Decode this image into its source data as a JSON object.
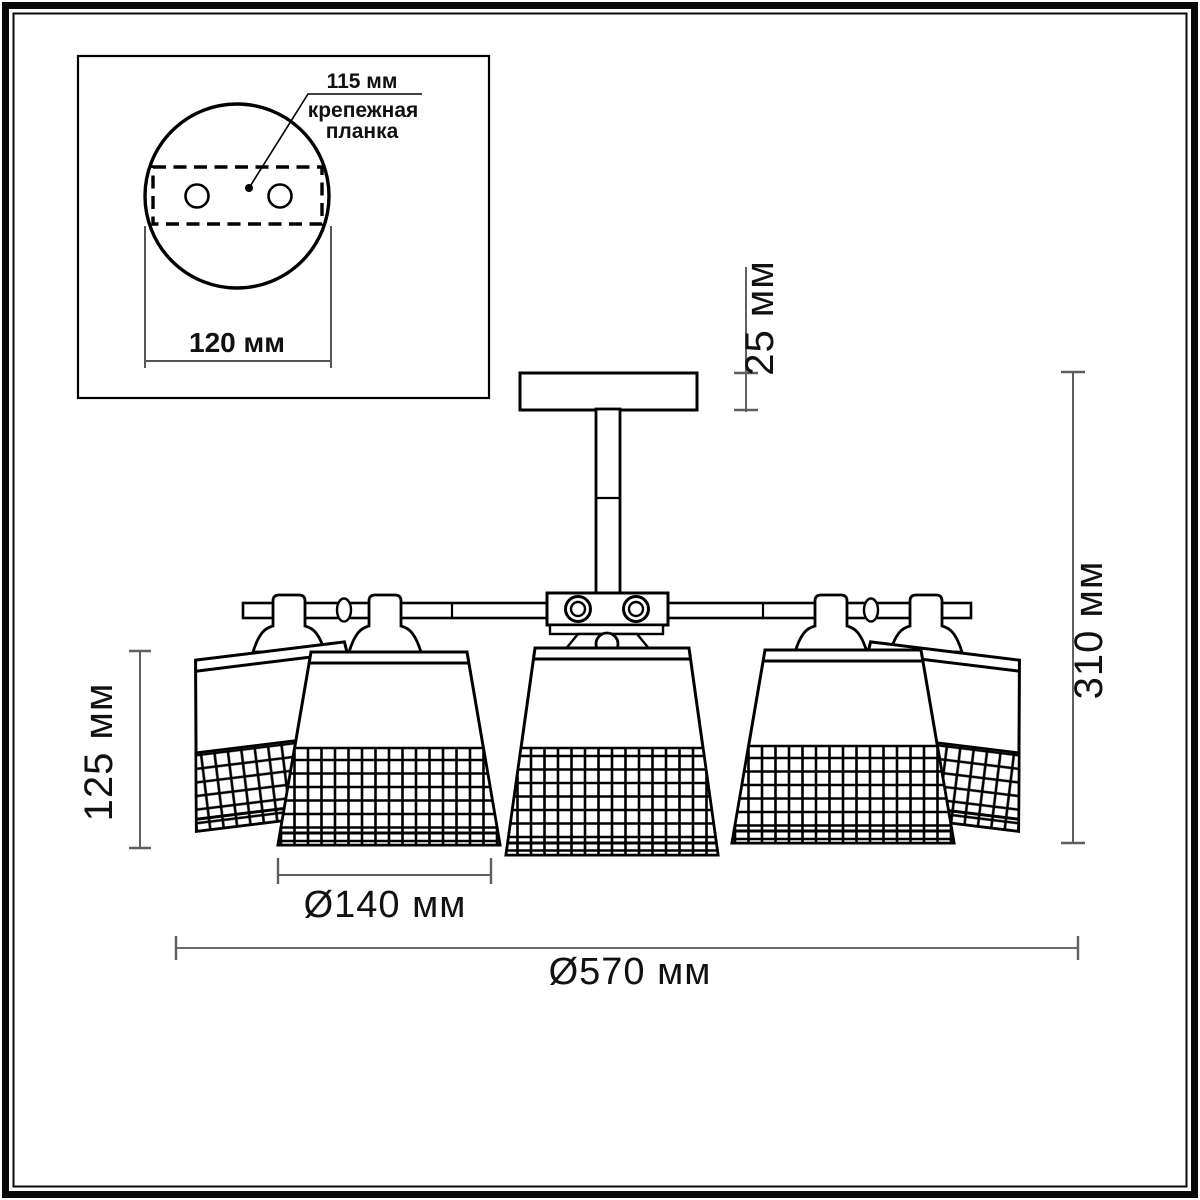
{
  "figure": {
    "inset": {
      "hole_spacing": "115 мм",
      "bracket_line1": "крепежная",
      "bracket_line2": "планка",
      "plate_width": "120 мм"
    },
    "dimensions": {
      "canopy_height": "25 мм",
      "total_height": "310 мм",
      "shade_height": "125 мм",
      "shade_diameter": "Ø140 мм",
      "total_diameter": "Ø570 мм"
    },
    "colors": {
      "line": "#000000",
      "dimension_line": "#5f5f5f",
      "background": "#ffffff"
    }
  }
}
